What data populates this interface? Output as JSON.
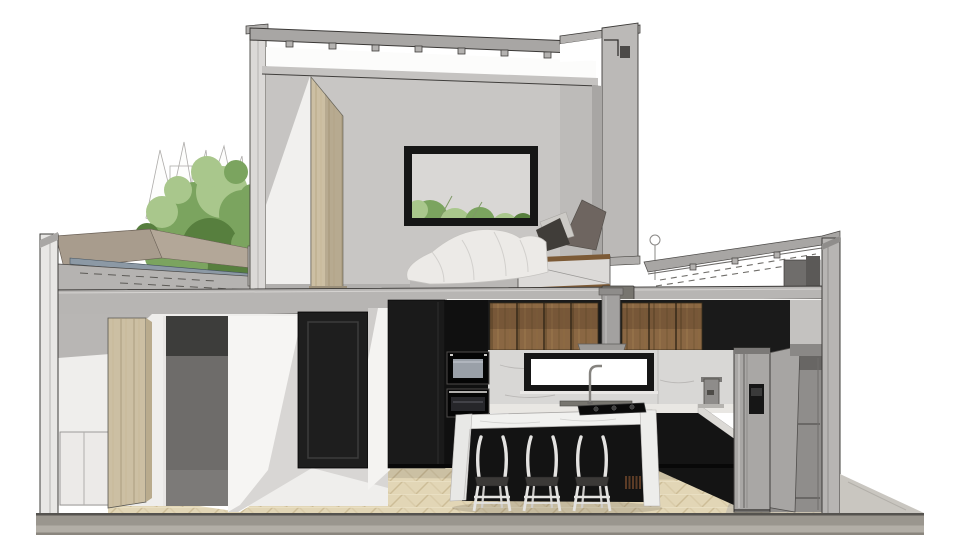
{
  "canvas": {
    "width": 965,
    "height": 560
  },
  "colors": {
    "background": "#ffffff",
    "wall": "#c8c6c4",
    "wall_dark": "#bdbbb9",
    "wall_lit": "#f1f0ee",
    "poche": "#b7b5b3",
    "roof": "#a8a6a4",
    "ceiling_slab": "#c5c3c1",
    "metal_flashing": "#8c99a5",
    "parapet_taupe": "#a89c8d",
    "foliage": "#7ba45f",
    "foliage_light": "#a9c78c",
    "foliage_dark": "#577f3e",
    "trunk": "#4a3d2f",
    "picture_frame": "#161616",
    "picture_mat": "#d9d7d5",
    "duvet": "#eceae7",
    "pillow_dark": "#403d39",
    "pillow_taupe": "#6e6560",
    "pillow_light": "#cccac6",
    "platform_wood": "#7c5a36",
    "platform_face": "#dcdad8",
    "light_wood": "#ccbfa3",
    "black_cabinet": "#1a1a1a",
    "wood_cabinet": "#8a6743",
    "marble_backsplash": "#d8d7d5",
    "island_marble": "#f1f1ef",
    "island_base": "#131313",
    "window_glass": "#ffffff",
    "hood_gray": "#a3a1a0",
    "fridge_gray": "#a9a7a5",
    "stool_frame": "#e4e3e1",
    "stool_seat": "#3b3937",
    "door_black": "#1e1e1e",
    "niche_dark": "#3d3d3b",
    "niche_mid": "#6e6c6a",
    "parquet": "#e2d6b6",
    "ground_slab": "#9a968e",
    "pantry_gray": "#8f8d8b"
  },
  "scene": {
    "description": "Cut-away cross-section rendering of a two-storey house",
    "style": "sketchup-like architectural section",
    "upper_level": {
      "room": "bedroom",
      "objects": [
        "framed picture with greenery",
        "platform bed",
        "white duvet",
        "pillows",
        "tall light-wood wardrobe panel",
        "roof slab with rafter blocks",
        "right parapet with gutter"
      ]
    },
    "lower_level": {
      "room": "kitchen and entry hall",
      "objects": [
        "black tall cabinets",
        "stacked wall ovens",
        "walnut upper cabinets",
        "range hood duct",
        "marble backsplash",
        "backlit kitchen window",
        "faucet and sink",
        "coffee machine",
        "waterfall marble island",
        "gas cooktop",
        "bar stools",
        "fridge with dispenser",
        "open pantry with door",
        "black interior door",
        "dark door niche",
        "light-wood wardrobe",
        "herringbone parquet floor"
      ]
    },
    "exterior": {
      "objects": [
        "tree with green foliage",
        "sketched bare branches",
        "terrace parapet with metal flashing",
        "single-storey side roof with joist hangers",
        "concrete ground slab"
      ]
    },
    "counts": {
      "bar_stools": 3,
      "wall_ovens": 2,
      "upper_cabinet_doors_left_run": 4,
      "upper_cabinet_doors_right_run": 3,
      "roof_rafter_blocks": 8,
      "side_roof_joist_hangers": 3
    }
  }
}
